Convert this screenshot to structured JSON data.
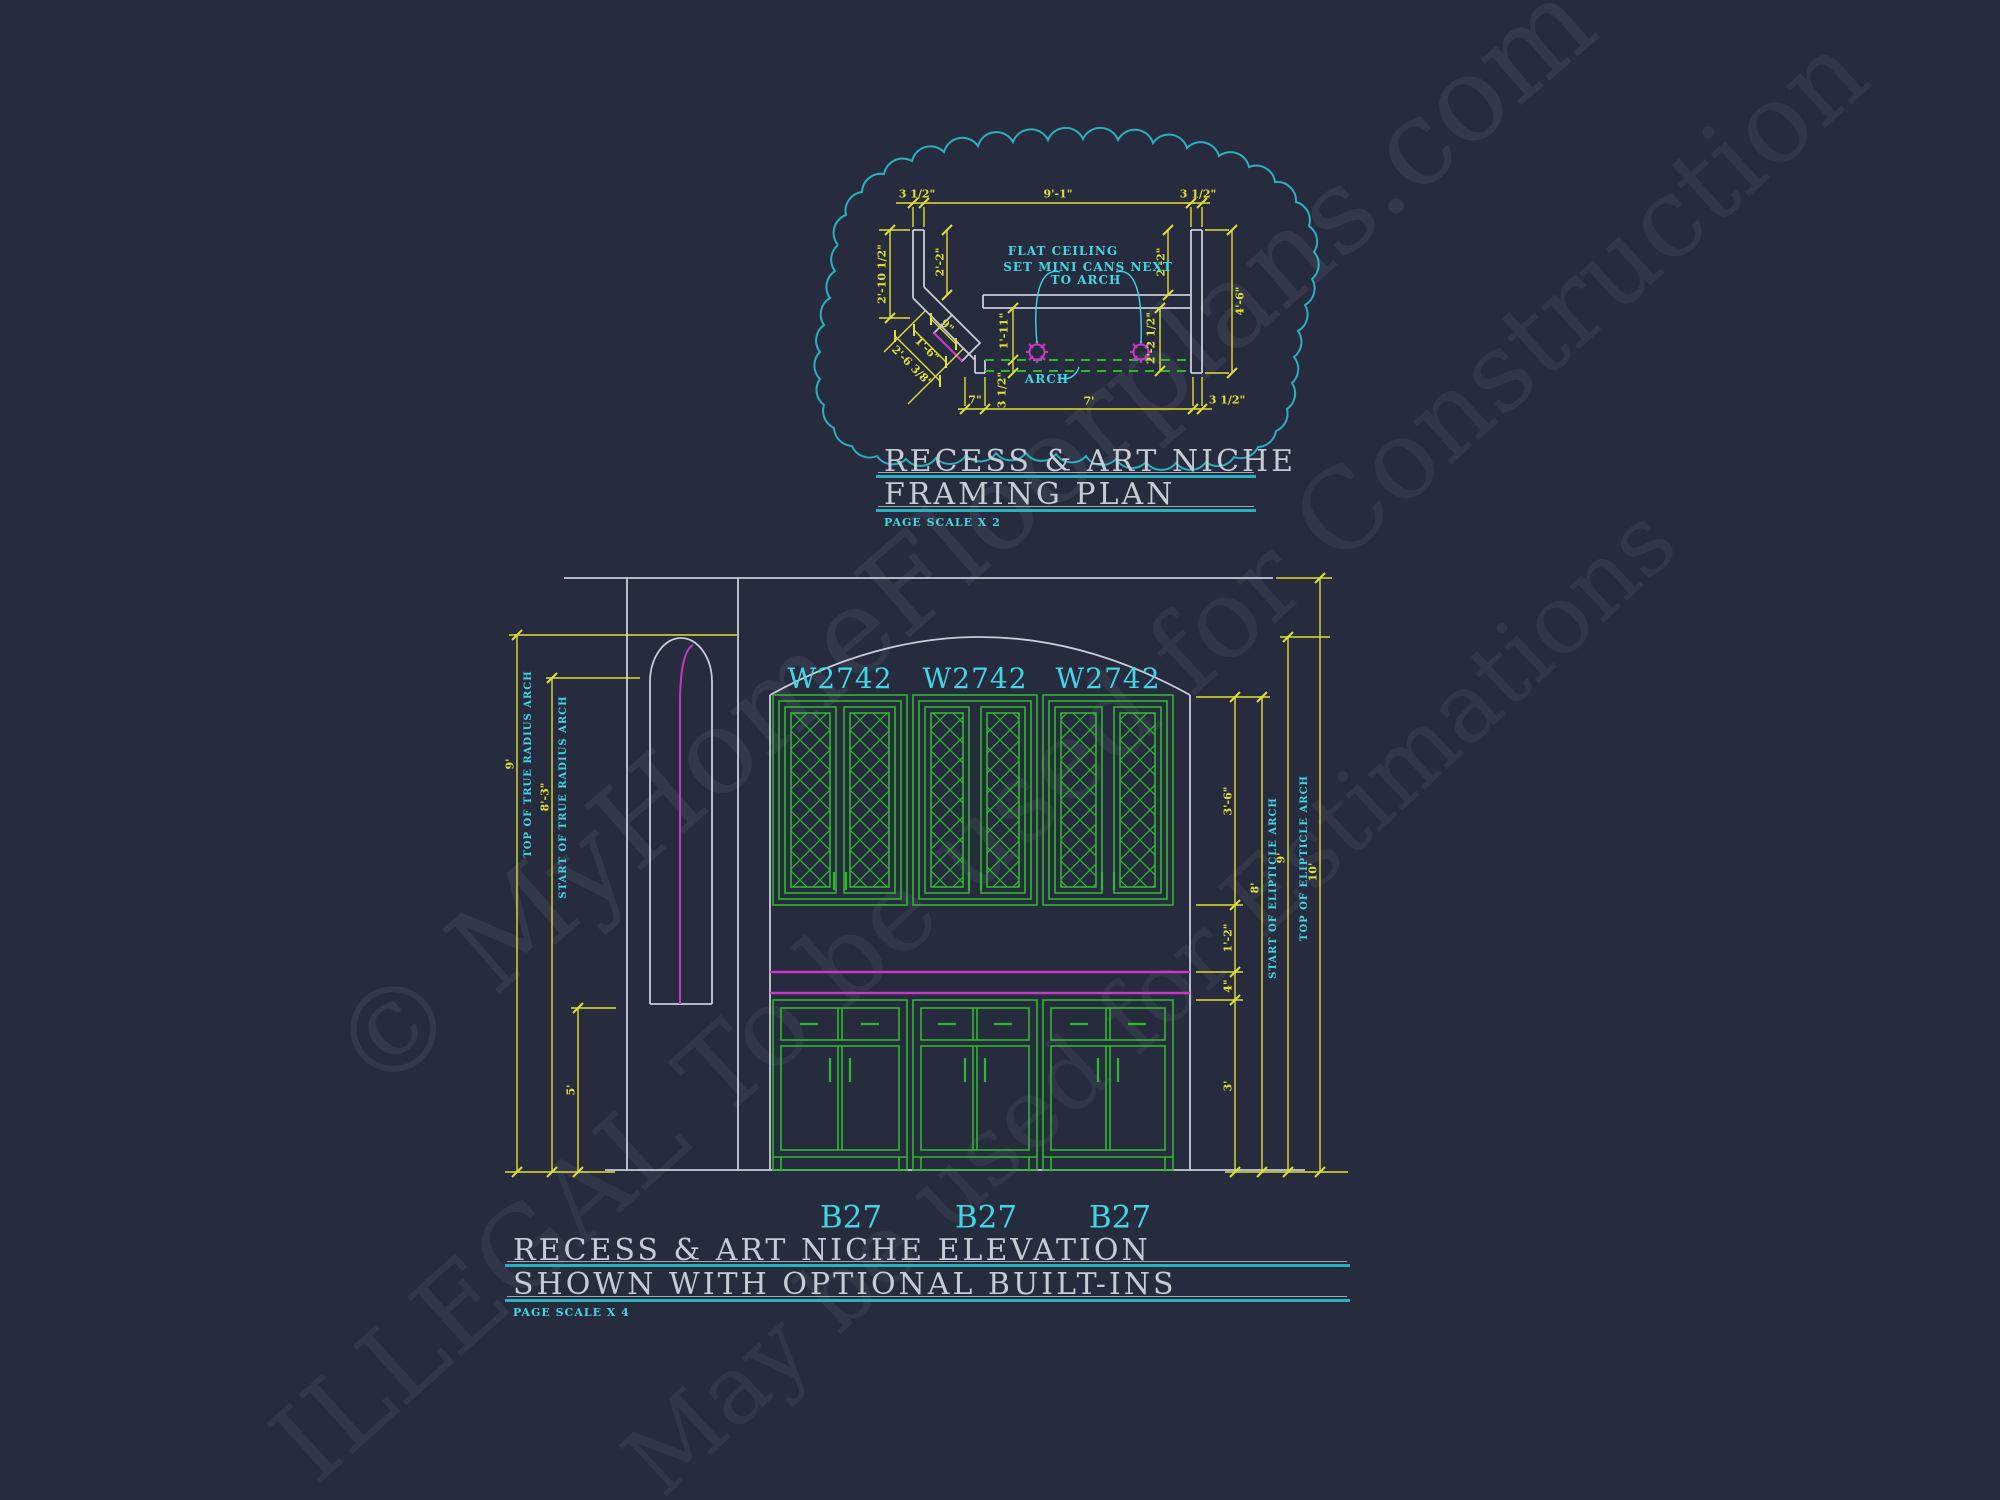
{
  "framing_plan": {
    "title": [
      "RECESS & ART NICHE",
      "FRAMING PLAN"
    ],
    "page_scale": "PAGE SCALE X 2",
    "notes": {
      "flat_ceiling": "FLAT CEILING",
      "mini_cans_line1": "SET MINI CANS NEXT",
      "mini_cans_line2": "TO ARCH",
      "arch": "ARCH"
    },
    "dims": {
      "stud_left": "3 1/2\"",
      "opening_width": "9'-1\"",
      "stud_right": "3 1/2\"",
      "left_outer": "2'-10 1/2\"",
      "left_inner": "2'-2\"",
      "right_inner": "2'-2\"",
      "right_outer": "4'-6\"",
      "header_height": "1'-11\"",
      "arch_band": "3 1/2\"",
      "right_depth": "2'-2 1/2\"",
      "niche_width": "9\"",
      "niche_opening": "1'-6\"",
      "niche_diagonal": "2'-6 3/8\"",
      "bottom_left": "7\"",
      "bottom_span": "7'",
      "bottom_right": "3 1/2\""
    }
  },
  "elevation": {
    "title": [
      "RECESS & ART NICHE ELEVATION",
      "SHOWN WITH OPTIONAL BUILT-INS"
    ],
    "page_scale": "PAGE SCALE X 4",
    "upper_cabinets": [
      "W2742",
      "W2742",
      "W2742"
    ],
    "base_cabinets": [
      "B27",
      "B27",
      "B27"
    ],
    "dims_left": {
      "overall": "9'",
      "overall_label": "TOP OF TRUE RADIUS ARCH",
      "arch_start": "8'-3\"",
      "arch_start_label": "START OF TRUE RADIUS ARCH",
      "niche_sill": "5'"
    },
    "dims_right": {
      "upper_cabinet_height": "3'-6\"",
      "counter_to_upper": "1'-2\"",
      "backsplash": "4\"",
      "counter_height": "3'",
      "arch_start": "8'",
      "arch_start_label": "START OF ELIPTICLE ARCH",
      "arch_top": "9'",
      "arch_top_label": "TOP OF ELIPTICLE ARCH",
      "ceiling_height": "10'"
    }
  },
  "watermark": {
    "line1": "© MyHomeFloorplans.com",
    "line2": "ILLEGAL To be used for Construction",
    "line3": "May be used for Estimations"
  },
  "colors": {
    "background": "#262b3d",
    "dimension_yellow": "#e0e032",
    "annotation_cyan": "#41d6e6",
    "cloud_teal": "#2ab0bf",
    "cabinet_green": "#2db82d",
    "accent_magenta": "#c838c8",
    "wall_white": "#c8cdd8"
  }
}
